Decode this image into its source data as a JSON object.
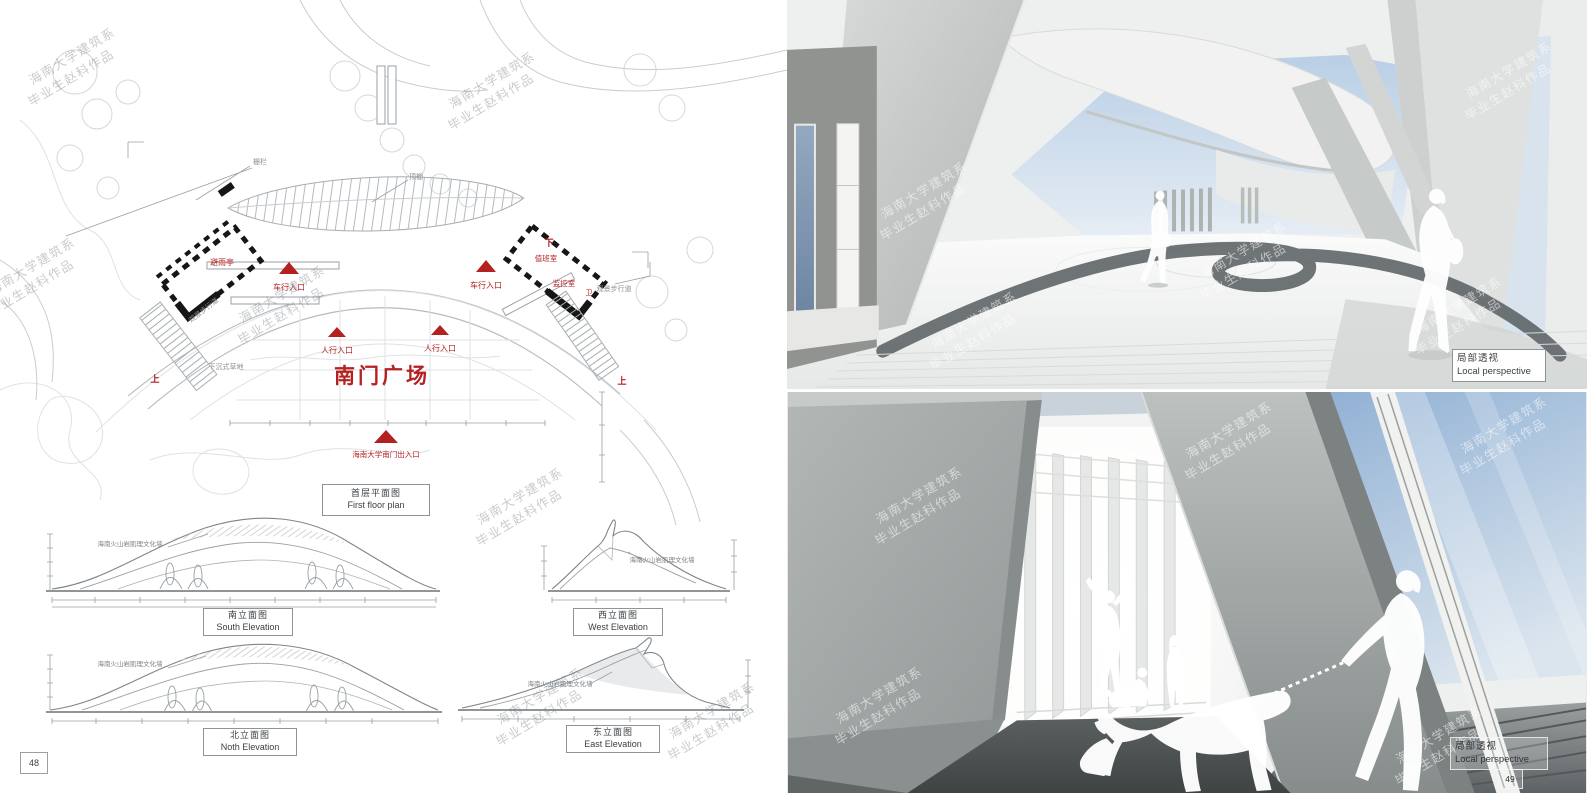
{
  "watermark": {
    "line1": "海南大学建筑系",
    "line2": "毕业生赵科作品"
  },
  "left_page": {
    "page_number": "48",
    "plan": {
      "title_cn": "首层平面图",
      "title_en": "First floor plan",
      "plaza": "南门广场",
      "vehicle_entrance": "车行入口",
      "pedestrian_entrance": "人行入口",
      "south_gate_entrance": "海南大学南门出入口",
      "rain_shelter": "避雨亭",
      "duty_room": "值班室",
      "monitor_room": "监控室",
      "wc": "卫",
      "up": "上",
      "down": "下",
      "fence": "栅栏",
      "canopy": "顶棚",
      "scenic_walkway": "观景步行道",
      "sunken_lawn": "下沉式草地"
    },
    "elevations": [
      {
        "cn": "南立面图",
        "en": "South Elevation",
        "note": "海南火山岩肌理文化墙"
      },
      {
        "cn": "西立面图",
        "en": "West Elevation",
        "note": "海南火山岩肌理文化墙"
      },
      {
        "cn": "北立面图",
        "en": "Noth Elevation",
        "note": "海南火山岩肌理文化墙"
      },
      {
        "cn": "东立面图",
        "en": "East Elevation",
        "note": "海南火山岩肌理文化墙"
      }
    ]
  },
  "right_page": {
    "page_number": "49",
    "renders": [
      {
        "label_cn": "局部透视",
        "label_en": "Local perspective"
      },
      {
        "label_cn": "局部透视",
        "label_en": "Local perspective"
      }
    ]
  },
  "colors": {
    "accent_red": "#b42121",
    "sky_blue": "#9db8d6"
  }
}
